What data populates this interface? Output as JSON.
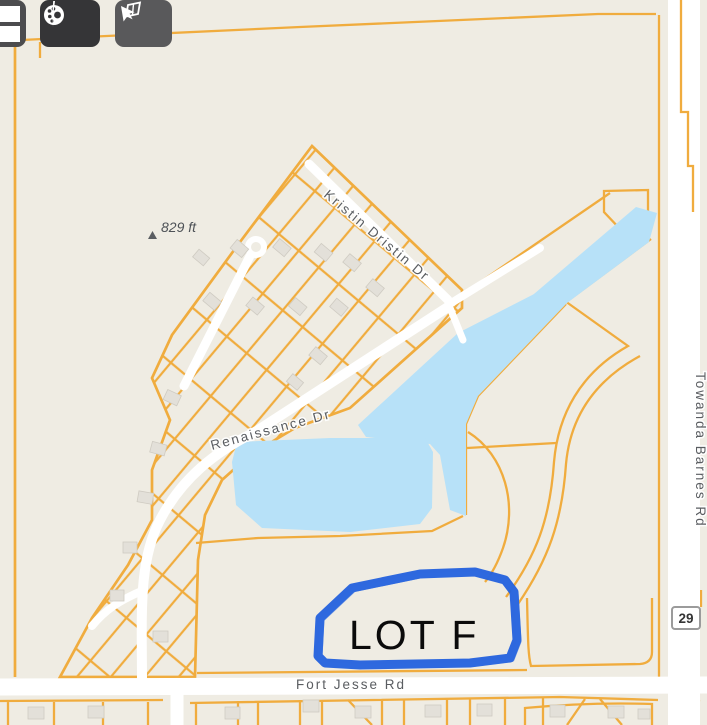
{
  "toolbar": {
    "buttons": [
      {
        "icon": "layers-icon"
      },
      {
        "icon": "palette-icon"
      },
      {
        "icon": "select-area-icon"
      }
    ]
  },
  "map": {
    "street_labels": {
      "kristin": "Kristin Dristin Dr",
      "renaissance": "Renaissance Dr",
      "fort_jesse": "Fort Jesse Rd",
      "towanda": "Towanda Barnes Rd"
    },
    "elevation_label": "829 ft",
    "route_shield": "29",
    "annotation": {
      "lot_label": "LOT F"
    },
    "colors": {
      "background": "#EFECE3",
      "parcel_line": "#F0AC3E",
      "road": "#FFFFFF",
      "water": "#B7E1F8",
      "building": "#E3E0D9",
      "annotation_blue": "#2361DD",
      "label_text": "#5A5D61"
    }
  }
}
